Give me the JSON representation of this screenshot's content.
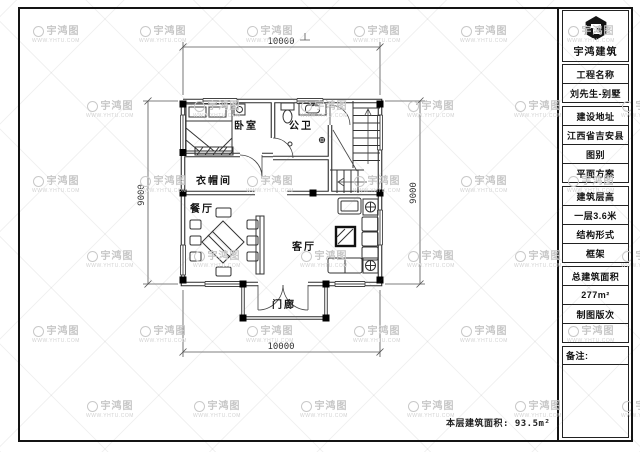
{
  "company": {
    "name": "宇鸿建筑",
    "watermark_text": "宇鸿图",
    "watermark_url": "WWW.YHTU.COM"
  },
  "colors": {
    "line": "#2b2b2b",
    "watermark": "#c6c6c6",
    "paper": "#ffffff"
  },
  "title_block": {
    "rows": [
      {
        "text": "工程名称",
        "kind": "label"
      },
      {
        "text": "刘先生-别墅",
        "kind": "value"
      },
      {
        "text": "建设地址",
        "kind": "label",
        "gap": true
      },
      {
        "text": "江西省吉安县",
        "kind": "value"
      },
      {
        "text": "图别",
        "kind": "label"
      },
      {
        "text": "平面方案",
        "kind": "value"
      },
      {
        "text": "建筑层高",
        "kind": "label",
        "gap": true
      },
      {
        "text": "一层3.6米",
        "kind": "value"
      },
      {
        "text": "结构形式",
        "kind": "label"
      },
      {
        "text": "框架",
        "kind": "value"
      },
      {
        "text": "总建筑面积",
        "kind": "label",
        "gap": true
      },
      {
        "text": "277m²",
        "kind": "value"
      },
      {
        "text": "制图版次",
        "kind": "label"
      },
      {
        "text": "",
        "kind": "empty"
      },
      {
        "text": "备注:",
        "kind": "note",
        "gap": true
      },
      {
        "text": "",
        "kind": "fill"
      }
    ]
  },
  "plan": {
    "rooms": {
      "bedroom": "卧室",
      "bathroom": "公卫",
      "cloakroom": "衣帽间",
      "dining": "餐厅",
      "living": "客厅",
      "porch": "门廊"
    },
    "dimensions": {
      "top": "10000",
      "bottom": "10000",
      "left": "9000",
      "right": "9000"
    },
    "area_note": "本层建筑面积: 93.5m²"
  }
}
